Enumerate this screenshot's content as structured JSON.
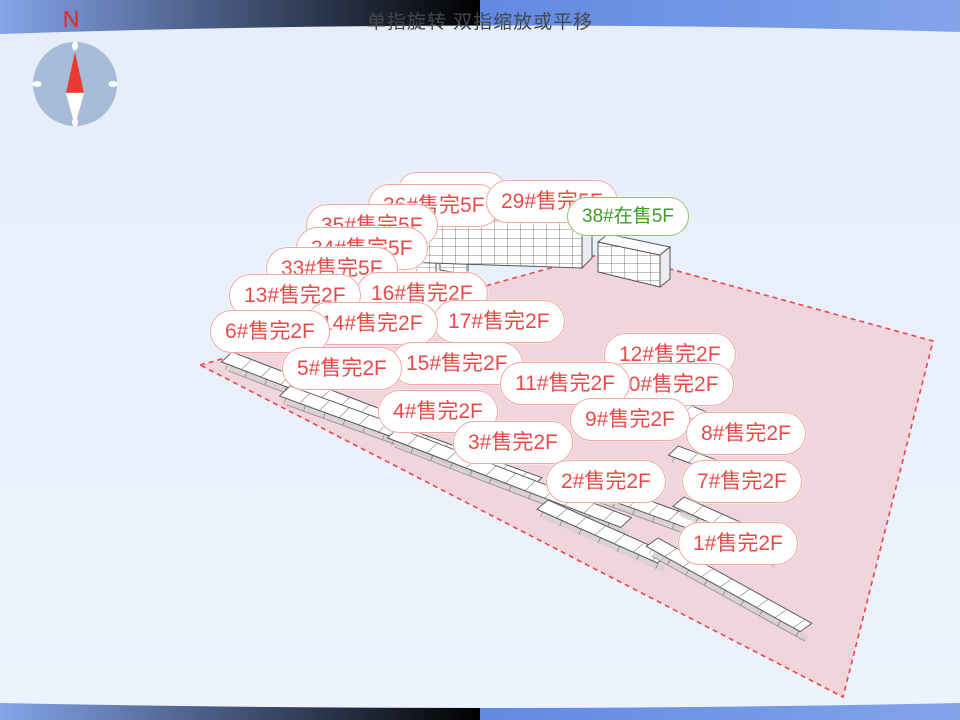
{
  "hint_text": "单指旋转 双指缩放或平移",
  "compass": {
    "north_label": "N"
  },
  "status_colors": {
    "sold_out": "#e84a4a",
    "on_sale": "#3f9e28"
  },
  "land": {
    "border_color": "#e94848",
    "fill_color": "#f0d3da"
  },
  "buildings": [
    {
      "id": "36",
      "label": "36#售完5F",
      "status": "sold_out",
      "floors": "5F"
    },
    {
      "id": "29",
      "label": "29#售完5F",
      "status": "sold_out",
      "floors": "5F"
    },
    {
      "id": "38",
      "label": "38#在售5F",
      "status": "on_sale",
      "floors": "5F"
    },
    {
      "id": "35",
      "label": "35#售完5F",
      "status": "sold_out",
      "floors": "5F"
    },
    {
      "id": "34",
      "label": "34#售完5F",
      "status": "sold_out",
      "floors": "5F"
    },
    {
      "id": "33",
      "label": "33#售完5F",
      "status": "sold_out",
      "floors": "5F"
    },
    {
      "id": "16",
      "label": "16#售完2F",
      "status": "sold_out",
      "floors": "2F"
    },
    {
      "id": "13",
      "label": "13#售完2F",
      "status": "sold_out",
      "floors": "2F"
    },
    {
      "id": "17",
      "label": "17#售完2F",
      "status": "sold_out",
      "floors": "2F"
    },
    {
      "id": "14",
      "label": "14#售完2F",
      "status": "sold_out",
      "floors": "2F"
    },
    {
      "id": "6",
      "label": "6#售完2F",
      "status": "sold_out",
      "floors": "2F"
    },
    {
      "id": "15",
      "label": "15#售完2F",
      "status": "sold_out",
      "floors": "2F"
    },
    {
      "id": "5",
      "label": "5#售完2F",
      "status": "sold_out",
      "floors": "2F"
    },
    {
      "id": "12",
      "label": "12#售完2F",
      "status": "sold_out",
      "floors": "2F"
    },
    {
      "id": "10",
      "label": "10#售完2F",
      "status": "sold_out",
      "floors": "2F"
    },
    {
      "id": "11",
      "label": "11#售完2F",
      "status": "sold_out",
      "floors": "2F"
    },
    {
      "id": "4",
      "label": "4#售完2F",
      "status": "sold_out",
      "floors": "2F"
    },
    {
      "id": "9",
      "label": "9#售完2F",
      "status": "sold_out",
      "floors": "2F"
    },
    {
      "id": "8",
      "label": "8#售完2F",
      "status": "sold_out",
      "floors": "2F"
    },
    {
      "id": "3",
      "label": "3#售完2F",
      "status": "sold_out",
      "floors": "2F"
    },
    {
      "id": "2",
      "label": "2#售完2F",
      "status": "sold_out",
      "floors": "2F"
    },
    {
      "id": "7",
      "label": "7#售完2F",
      "status": "sold_out",
      "floors": "2F"
    },
    {
      "id": "1",
      "label": "1#售完2F",
      "status": "sold_out",
      "floors": "2F"
    }
  ]
}
